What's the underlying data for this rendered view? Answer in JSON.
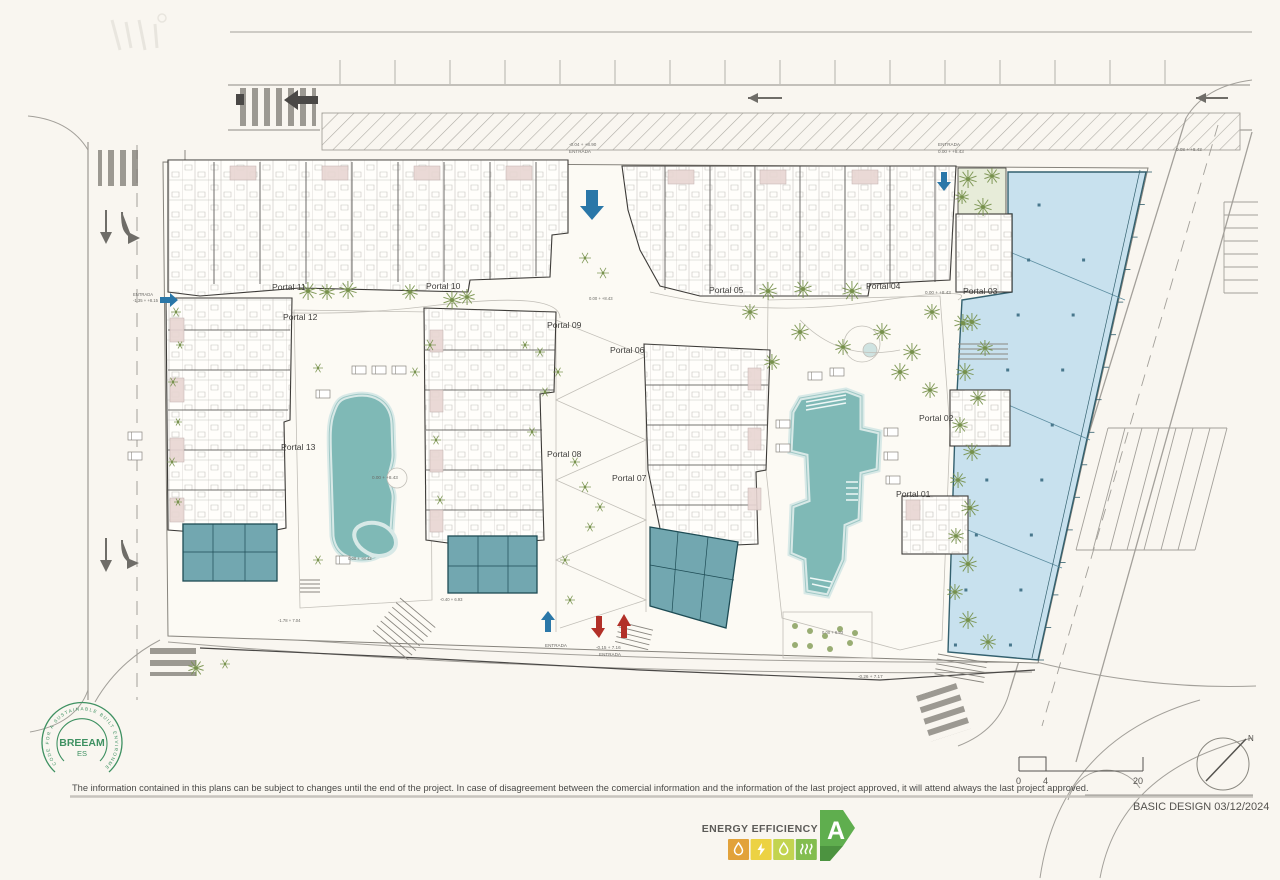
{
  "title_block": {
    "basic_design": "BASIC DESIGN 03/12/2024",
    "disclaimer": "The information contained in this plans can be subject to changes until the end of the project. In case of disagreement between the comercial information and the information of the last project approved, it will attend always the last project approved."
  },
  "breeam": {
    "name": "BREEAM",
    "region": "ES",
    "ring_text": "CODE FOR A SUSTAINABLE BUILT ENVIRONMENT"
  },
  "energy": {
    "label": "ENERGY EFFICIENCY",
    "rating": "A",
    "arrow_color": "#5fae4e",
    "fold_color": "#4c9340",
    "scale_colors": [
      "#e2a23b",
      "#ecd243",
      "#c3d450",
      "#83bd4f"
    ]
  },
  "scale_bar": {
    "start": "0",
    "mid": "4",
    "end": "20"
  },
  "compass": {
    "label": "N"
  },
  "plan": {
    "portals": [
      {
        "label": "Portal 01",
        "x": 896,
        "y": 497
      },
      {
        "label": "Portal 02",
        "x": 919,
        "y": 421
      },
      {
        "label": "Portal 03",
        "x": 963,
        "y": 294
      },
      {
        "label": "Portal 04",
        "x": 866,
        "y": 289
      },
      {
        "label": "Portal 05",
        "x": 709,
        "y": 293
      },
      {
        "label": "Portal 06",
        "x": 610,
        "y": 353
      },
      {
        "label": "Portal 07",
        "x": 612,
        "y": 481
      },
      {
        "label": "Portal 08",
        "x": 547,
        "y": 457
      },
      {
        "label": "Portal 09",
        "x": 547,
        "y": 328
      },
      {
        "label": "Portal 10",
        "x": 426,
        "y": 289
      },
      {
        "label": "Portal 11",
        "x": 272,
        "y": 290
      },
      {
        "label": "Portal 12",
        "x": 283,
        "y": 320
      },
      {
        "label": "Portal 13",
        "x": 281,
        "y": 450
      }
    ],
    "annotations": [
      {
        "text": "-0.04 + +8.90",
        "x": 569,
        "y": 146,
        "s": 4.6
      },
      {
        "text": "ENTRADA",
        "x": 569,
        "y": 153,
        "s": 4.6
      },
      {
        "text": "ENTRADA",
        "x": 938,
        "y": 146,
        "s": 4.6
      },
      {
        "text": "0.00 + +8.43",
        "x": 938,
        "y": 153,
        "s": 4.6
      },
      {
        "text": "0.08 + +8.43",
        "x": 1176,
        "y": 151,
        "s": 4.6
      },
      {
        "text": "ENTRADA",
        "x": 133,
        "y": 296,
        "s": 4.2
      },
      {
        "text": "-1.35 + +8.15",
        "x": 133,
        "y": 302,
        "s": 4.2
      },
      {
        "text": "0.00 + +8.43",
        "x": 925,
        "y": 294,
        "s": 4.6
      },
      {
        "text": "0.00 + +8.43",
        "x": 372,
        "y": 479,
        "s": 4.6
      },
      {
        "text": "0.00 + +8.43",
        "x": 348,
        "y": 560,
        "s": 4.2
      },
      {
        "text": "0.00 + +8.43",
        "x": 589,
        "y": 300,
        "s": 4.2
      },
      {
        "text": "-1.78 + 7.04",
        "x": 278,
        "y": 622,
        "s": 4.2
      },
      {
        "text": "ENTRADA",
        "x": 545,
        "y": 647,
        "s": 4.6
      },
      {
        "text": "-0.15 + 7.16",
        "x": 596,
        "y": 649,
        "s": 4.6
      },
      {
        "text": "ENTRADA",
        "x": 599,
        "y": 656,
        "s": 4.6
      },
      {
        "text": "-0.40 + 6.93",
        "x": 440,
        "y": 601,
        "s": 4.2
      },
      {
        "text": "-0.26 + 7.17",
        "x": 858,
        "y": 678,
        "s": 4.6
      },
      {
        "text": "0.00 + 6.93",
        "x": 822,
        "y": 634,
        "s": 4.2
      }
    ],
    "trees": [
      {
        "t": "palm",
        "x": 308,
        "y": 291,
        "r": 9
      },
      {
        "t": "palm",
        "x": 327,
        "y": 292,
        "r": 8
      },
      {
        "t": "palm",
        "x": 348,
        "y": 290,
        "r": 9
      },
      {
        "t": "palm",
        "x": 410,
        "y": 292,
        "r": 8
      },
      {
        "t": "palm",
        "x": 452,
        "y": 300,
        "r": 9
      },
      {
        "t": "palm",
        "x": 467,
        "y": 297,
        "r": 8
      },
      {
        "t": "bush",
        "x": 585,
        "y": 258,
        "r": 6
      },
      {
        "t": "bush",
        "x": 603,
        "y": 273,
        "r": 6
      },
      {
        "t": "palm",
        "x": 768,
        "y": 291,
        "r": 9
      },
      {
        "t": "palm",
        "x": 803,
        "y": 289,
        "r": 9
      },
      {
        "t": "palm",
        "x": 852,
        "y": 291,
        "r": 10
      },
      {
        "t": "palm",
        "x": 750,
        "y": 312,
        "r": 8
      },
      {
        "t": "palm",
        "x": 800,
        "y": 332,
        "r": 9
      },
      {
        "t": "palm",
        "x": 843,
        "y": 347,
        "r": 8
      },
      {
        "t": "palm",
        "x": 882,
        "y": 332,
        "r": 9
      },
      {
        "t": "palm",
        "x": 912,
        "y": 352,
        "r": 9
      },
      {
        "t": "palm",
        "x": 932,
        "y": 312,
        "r": 8
      },
      {
        "t": "palm",
        "x": 963,
        "y": 323,
        "r": 9
      },
      {
        "t": "palm",
        "x": 900,
        "y": 372,
        "r": 9
      },
      {
        "t": "palm",
        "x": 772,
        "y": 362,
        "r": 8
      },
      {
        "t": "palm",
        "x": 930,
        "y": 390,
        "r": 8
      },
      {
        "t": "palm",
        "x": 968,
        "y": 179,
        "r": 9
      },
      {
        "t": "palm",
        "x": 992,
        "y": 176,
        "r": 8
      },
      {
        "t": "palm",
        "x": 983,
        "y": 207,
        "r": 9
      },
      {
        "t": "palm",
        "x": 962,
        "y": 197,
        "r": 7
      },
      {
        "t": "palm",
        "x": 972,
        "y": 322,
        "r": 9
      },
      {
        "t": "palm",
        "x": 985,
        "y": 348,
        "r": 8
      },
      {
        "t": "palm",
        "x": 965,
        "y": 372,
        "r": 9
      },
      {
        "t": "palm",
        "x": 978,
        "y": 398,
        "r": 8
      },
      {
        "t": "palm",
        "x": 960,
        "y": 425,
        "r": 8
      },
      {
        "t": "palm",
        "x": 972,
        "y": 452,
        "r": 9
      },
      {
        "t": "palm",
        "x": 958,
        "y": 480,
        "r": 8
      },
      {
        "t": "palm",
        "x": 970,
        "y": 508,
        "r": 9
      },
      {
        "t": "palm",
        "x": 956,
        "y": 536,
        "r": 8
      },
      {
        "t": "palm",
        "x": 968,
        "y": 564,
        "r": 9
      },
      {
        "t": "palm",
        "x": 955,
        "y": 592,
        "r": 8
      },
      {
        "t": "palm",
        "x": 968,
        "y": 620,
        "r": 9
      },
      {
        "t": "palm",
        "x": 988,
        "y": 642,
        "r": 8
      },
      {
        "t": "bush",
        "x": 540,
        "y": 352,
        "r": 5
      },
      {
        "t": "bush",
        "x": 558,
        "y": 372,
        "r": 5
      },
      {
        "t": "bush",
        "x": 545,
        "y": 392,
        "r": 5
      },
      {
        "t": "bush",
        "x": 532,
        "y": 432,
        "r": 5
      },
      {
        "t": "bush",
        "x": 585,
        "y": 487,
        "r": 6
      },
      {
        "t": "bush",
        "x": 600,
        "y": 507,
        "r": 5
      },
      {
        "t": "bush",
        "x": 590,
        "y": 527,
        "r": 5
      },
      {
        "t": "bush",
        "x": 575,
        "y": 462,
        "r": 5
      },
      {
        "t": "bush",
        "x": 525,
        "y": 345,
        "r": 4
      },
      {
        "t": "bush",
        "x": 176,
        "y": 312,
        "r": 5
      },
      {
        "t": "bush",
        "x": 180,
        "y": 345,
        "r": 4
      },
      {
        "t": "bush",
        "x": 173,
        "y": 382,
        "r": 5
      },
      {
        "t": "bush",
        "x": 178,
        "y": 422,
        "r": 4
      },
      {
        "t": "bush",
        "x": 172,
        "y": 462,
        "r": 5
      },
      {
        "t": "bush",
        "x": 178,
        "y": 502,
        "r": 4
      },
      {
        "t": "palm",
        "x": 196,
        "y": 668,
        "r": 8
      },
      {
        "t": "bush",
        "x": 225,
        "y": 664,
        "r": 5
      },
      {
        "t": "dot",
        "x": 795,
        "y": 626,
        "r": 3
      },
      {
        "t": "dot",
        "x": 810,
        "y": 631,
        "r": 3
      },
      {
        "t": "dot",
        "x": 825,
        "y": 636,
        "r": 3
      },
      {
        "t": "dot",
        "x": 840,
        "y": 629,
        "r": 3
      },
      {
        "t": "dot",
        "x": 855,
        "y": 633,
        "r": 3
      },
      {
        "t": "dot",
        "x": 810,
        "y": 646,
        "r": 3
      },
      {
        "t": "dot",
        "x": 830,
        "y": 649,
        "r": 3
      },
      {
        "t": "dot",
        "x": 850,
        "y": 643,
        "r": 3
      },
      {
        "t": "dot",
        "x": 795,
        "y": 645,
        "r": 3
      },
      {
        "t": "bush",
        "x": 318,
        "y": 368,
        "r": 5
      },
      {
        "t": "bush",
        "x": 415,
        "y": 372,
        "r": 5
      },
      {
        "t": "bush",
        "x": 430,
        "y": 345,
        "r": 6
      },
      {
        "t": "bush",
        "x": 436,
        "y": 440,
        "r": 5
      },
      {
        "t": "bush",
        "x": 440,
        "y": 500,
        "r": 5
      },
      {
        "t": "bush",
        "x": 318,
        "y": 560,
        "r": 5
      },
      {
        "t": "bush",
        "x": 565,
        "y": 560,
        "r": 5
      },
      {
        "t": "bush",
        "x": 570,
        "y": 600,
        "r": 5
      }
    ],
    "colors": {
      "pool": "#7fb9b6",
      "pool_rim": "#d8e9e7",
      "commercial_glass": "#c8e1ee",
      "commercial_unit": "#72a7b0",
      "terrace": "#e8d6d3",
      "tree": "#75904a",
      "road": "#a3a09a",
      "arrow_blue": "#2a77a8",
      "arrow_red": "#b23028",
      "line": "#55524d"
    }
  }
}
